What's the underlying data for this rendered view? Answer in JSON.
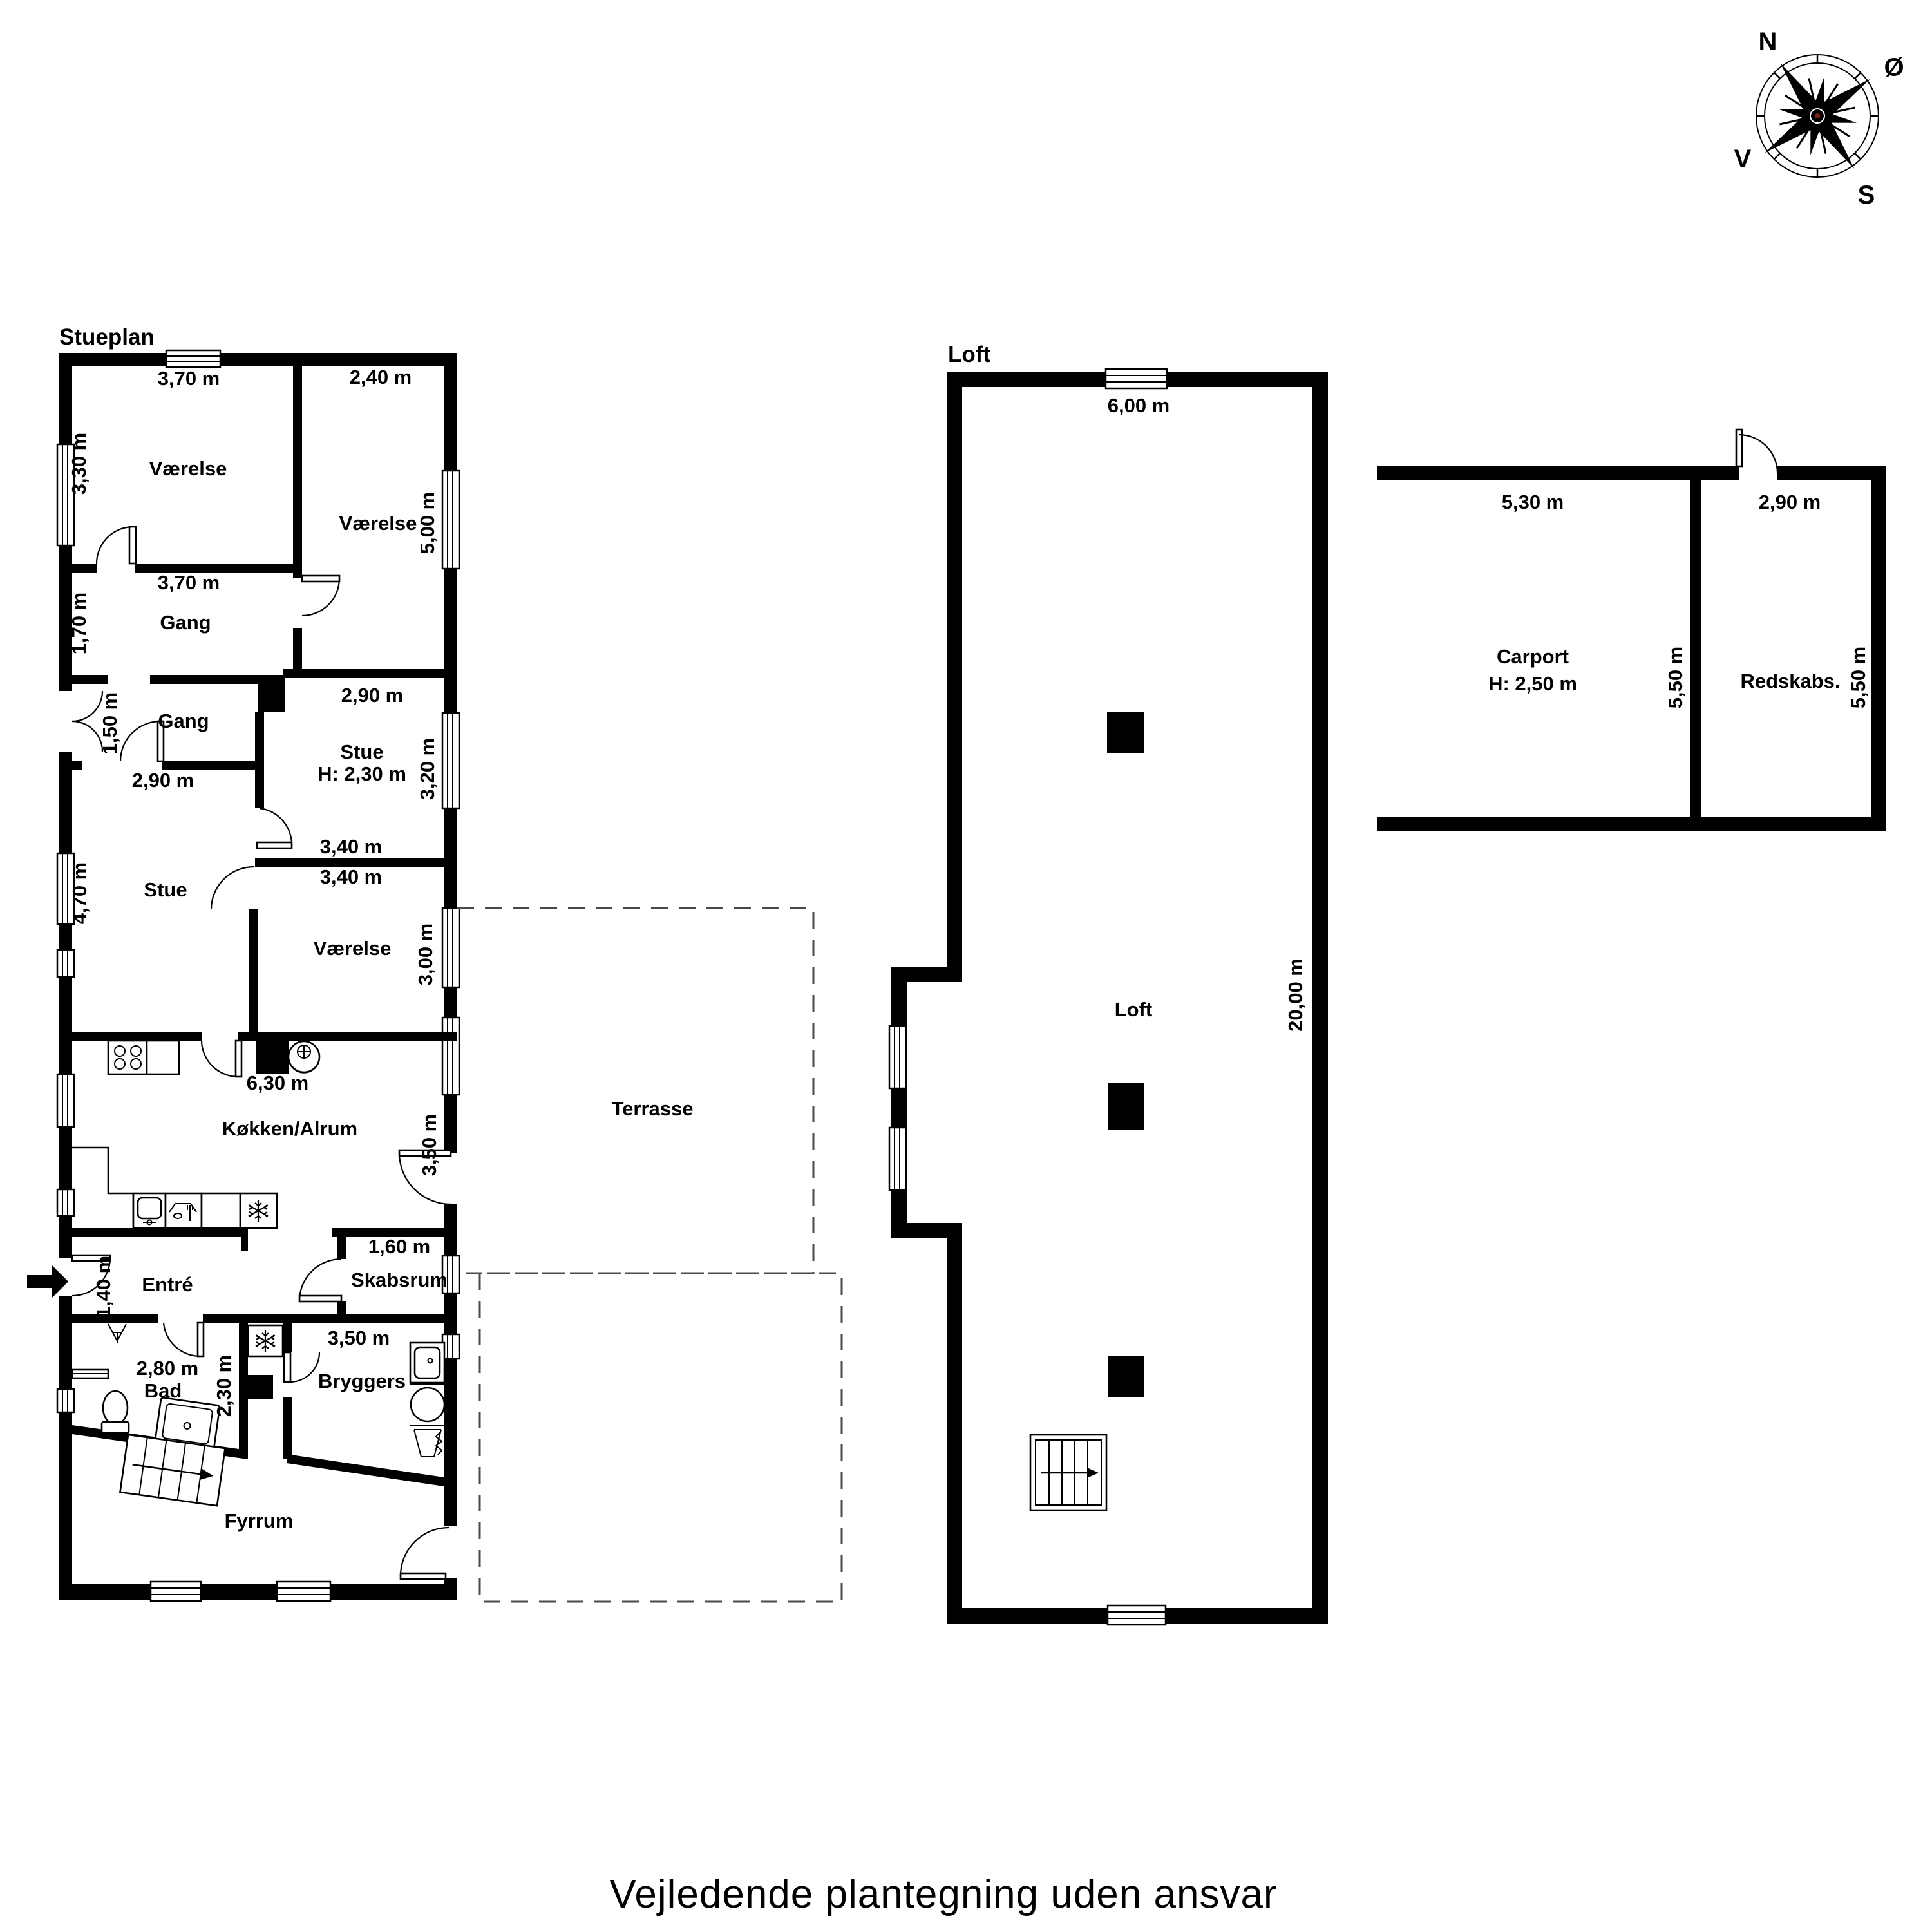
{
  "footer": {
    "disclaimer": "Vejledende plantegning uden ansvar"
  },
  "compass": {
    "north": "N",
    "east": "Ø",
    "south": "S",
    "west": "V"
  },
  "colors": {
    "wall": "#000000",
    "background": "#ffffff",
    "dashed_outline": "#4a4a4a"
  },
  "stueplan": {
    "title": "Stueplan",
    "rooms": {
      "vaerelse_nw": {
        "label": "Værelse",
        "width_top": "3,70 m",
        "height_left": "3,30 m"
      },
      "vaerelse_ne": {
        "label": "Værelse",
        "width_top": "2,40 m",
        "height_right": "5,00 m"
      },
      "gang_upper": {
        "label": "Gang",
        "width_top": "3,70 m",
        "height_left": "1,70 m"
      },
      "gang_lower": {
        "label": "Gang",
        "height_left": "1,50 m",
        "width_bottom": "2,90 m"
      },
      "stue_lille": {
        "label": "Stue",
        "ceiling_height": "H: 2,30 m",
        "width_top": "2,90 m",
        "height_right": "3,20 m",
        "width_bottom": "3,40 m"
      },
      "stue": {
        "label": "Stue",
        "height_left": "4,70 m"
      },
      "vaerelse_midt": {
        "label": "Værelse",
        "width_top": "3,40 m",
        "height_right": "3,00 m"
      },
      "koekken_alrum": {
        "label": "Køkken/Alrum",
        "width_top": "6,30 m",
        "height_right": "3,50 m"
      },
      "terrasse": {
        "label": "Terrasse"
      },
      "entre": {
        "label": "Entré",
        "height_left": "1,40 m"
      },
      "skabsrum": {
        "label": "Skabsrum",
        "width_top": "1,60 m"
      },
      "bryggers": {
        "label": "Bryggers",
        "width_top": "3,50 m"
      },
      "bad": {
        "label": "Bad",
        "width_top": "2,80 m",
        "height_right": "2,30 m"
      },
      "fyrrum": {
        "label": "Fyrrum"
      }
    }
  },
  "loft_plan": {
    "title": "Loft",
    "room_label": "Loft",
    "width_top": "6,00 m",
    "height_right": "20,00 m"
  },
  "outbuilding": {
    "carport": {
      "label": "Carport",
      "ceiling_height": "H: 2,50 m",
      "width_top": "5,30 m",
      "height_right": "5,50 m"
    },
    "redskabsrum": {
      "label": "Redskabs.",
      "width_top": "2,90 m",
      "height_right": "5,50 m"
    }
  }
}
